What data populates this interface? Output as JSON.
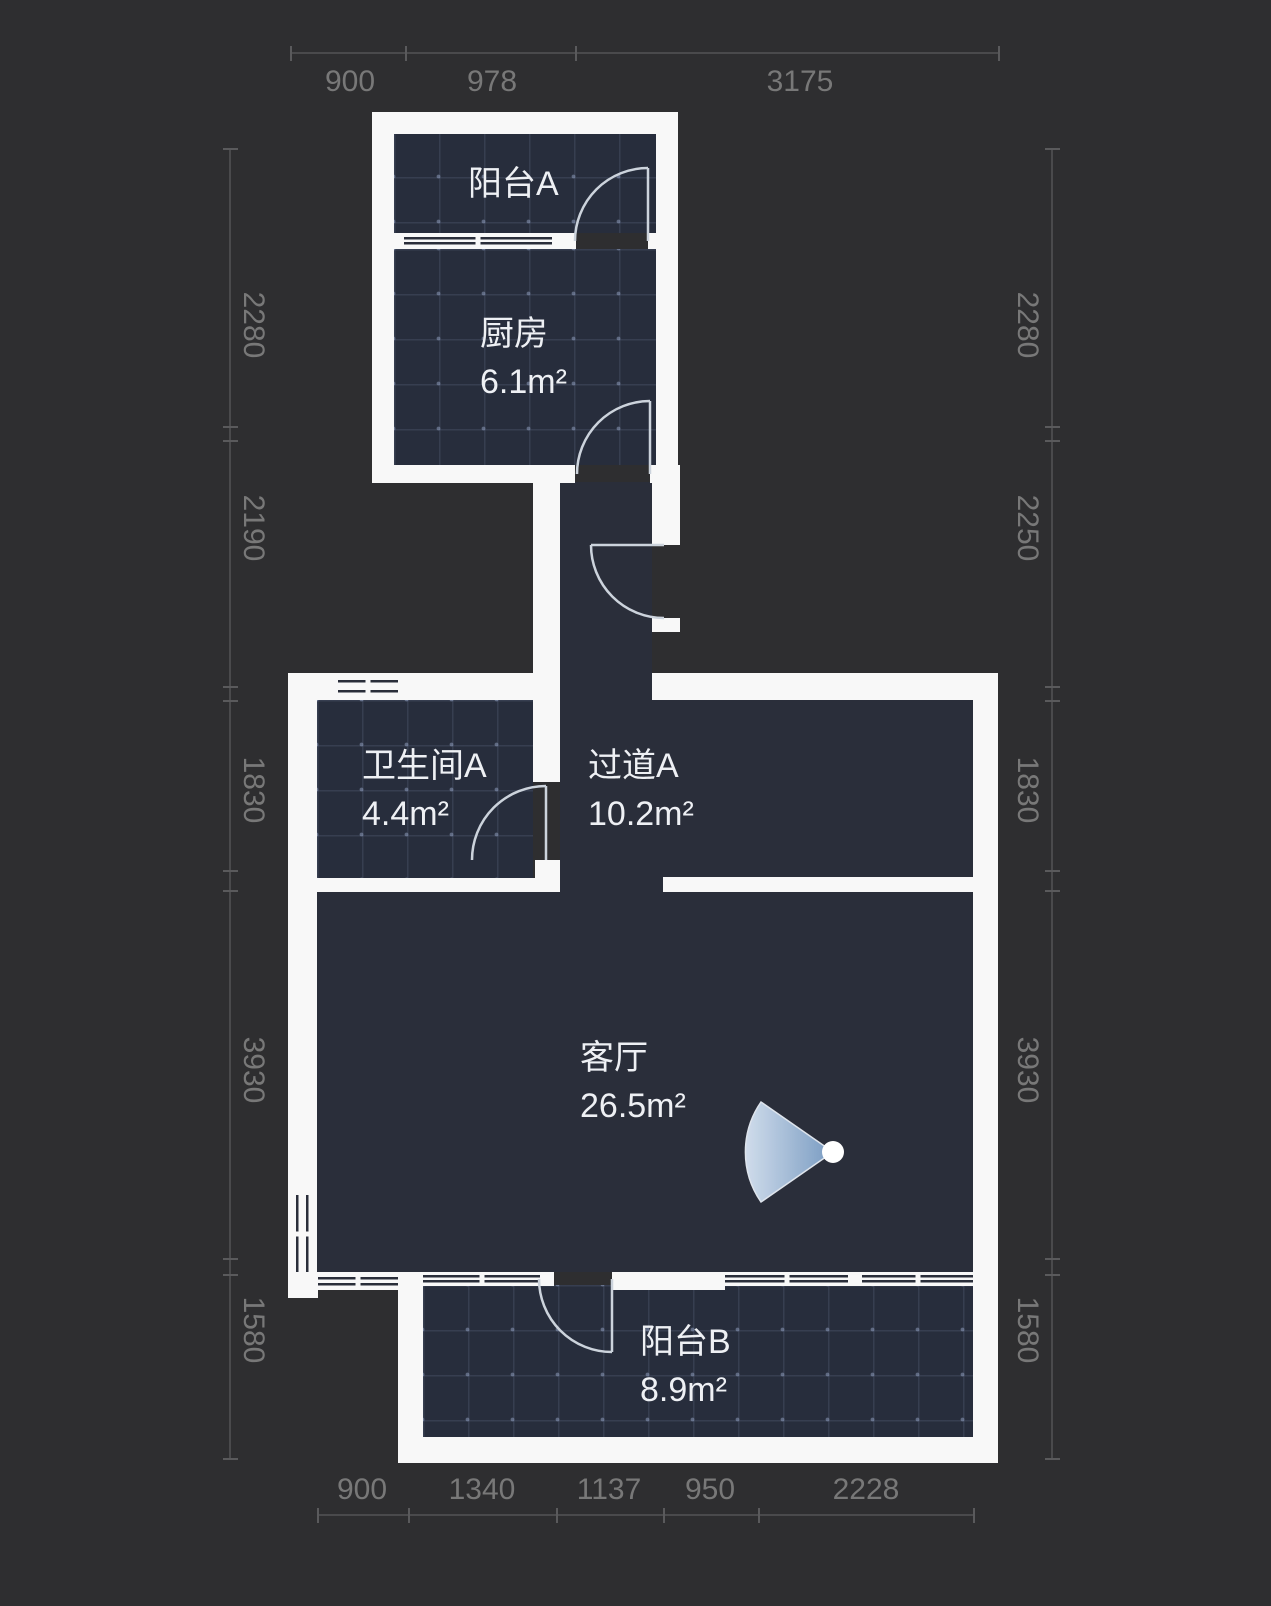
{
  "title": "户型图",
  "rooms": [
    {
      "id": "balcony-a",
      "name": "阳台A",
      "area": ""
    },
    {
      "id": "kitchen",
      "name": "厨房",
      "area": "6.1m²"
    },
    {
      "id": "bathroom-a",
      "name": "卫生间A",
      "area": "4.4m²"
    },
    {
      "id": "hallway-a",
      "name": "过道A",
      "area": "10.2m²"
    },
    {
      "id": "living-room",
      "name": "客厅",
      "area": "26.5m²"
    },
    {
      "id": "balcony-b",
      "name": "阳台B",
      "area": "8.9m²"
    }
  ],
  "rulers": {
    "top": {
      "labels": [
        "900",
        "978",
        "3175"
      ]
    },
    "bottom": {
      "labels": [
        "900",
        "1340",
        "1137",
        "950",
        "2228"
      ]
    },
    "left": {
      "labels": [
        "2280",
        "2190",
        "1830",
        "3930",
        "1580"
      ]
    },
    "right": {
      "labels": [
        "2280",
        "2250",
        "1830",
        "3930",
        "1580"
      ]
    }
  },
  "icons": {
    "camera": "camera-view-cone"
  },
  "colors": {
    "background": "#2e2e30",
    "wall": "#f8f8f8",
    "room_fill": "#2a2e3a",
    "tile_fill": "#272d3c",
    "dimension_text": "#787878",
    "label_text": "#eef0f4",
    "door_arc": "#ccd3dc",
    "camera_cone_light": "#d9e6f5",
    "camera_cone_dark": "#7da1c9"
  }
}
